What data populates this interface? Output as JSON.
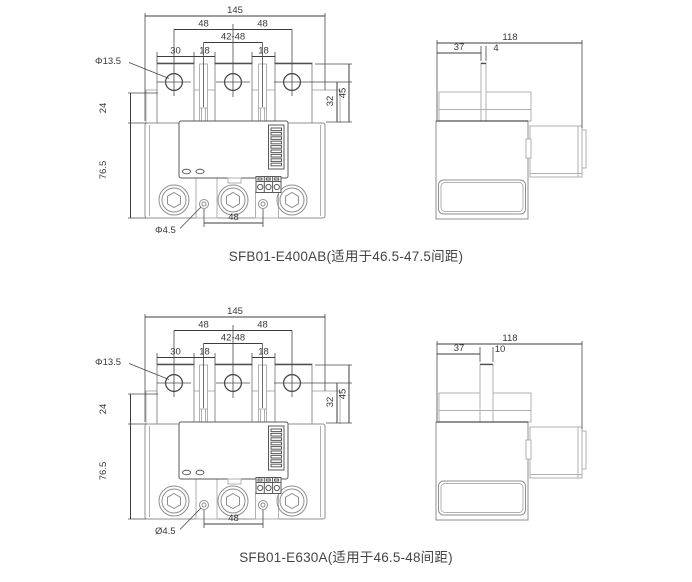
{
  "drawings": [
    {
      "title": "SFB01-E400AB(适用于46.5-47.5间距)",
      "front": {
        "overall_width": "145",
        "pitch_left": "48",
        "pitch_right": "48",
        "adjustable_pitch": "42-48",
        "tab_width": "30",
        "gap_left": "18",
        "gap_right": "18",
        "hole_dia": "Φ13.5",
        "top_offset": "24",
        "body_height": "76.5",
        "right_offset": "32",
        "right_height": "45",
        "small_hole_dia": "Φ4.5",
        "bottom_pitch": "48"
      },
      "side": {
        "overall_width": "118",
        "tab_offset": "37",
        "tab_width": "4"
      }
    },
    {
      "title": "SFB01-E630A(适用于46.5-48间距)",
      "front": {
        "overall_width": "145",
        "pitch_left": "48",
        "pitch_right": "48",
        "adjustable_pitch": "42-48",
        "tab_width": "30",
        "gap_left": "18",
        "gap_right": "18",
        "hole_dia": "Φ13.5",
        "top_offset": "24",
        "body_height": "76.5",
        "right_offset": "32",
        "right_height": "45",
        "small_hole_dia": "Ø4.5",
        "bottom_pitch": "48"
      },
      "side": {
        "overall_width": "118",
        "tab_offset": "37",
        "tab_width": "10"
      }
    }
  ]
}
